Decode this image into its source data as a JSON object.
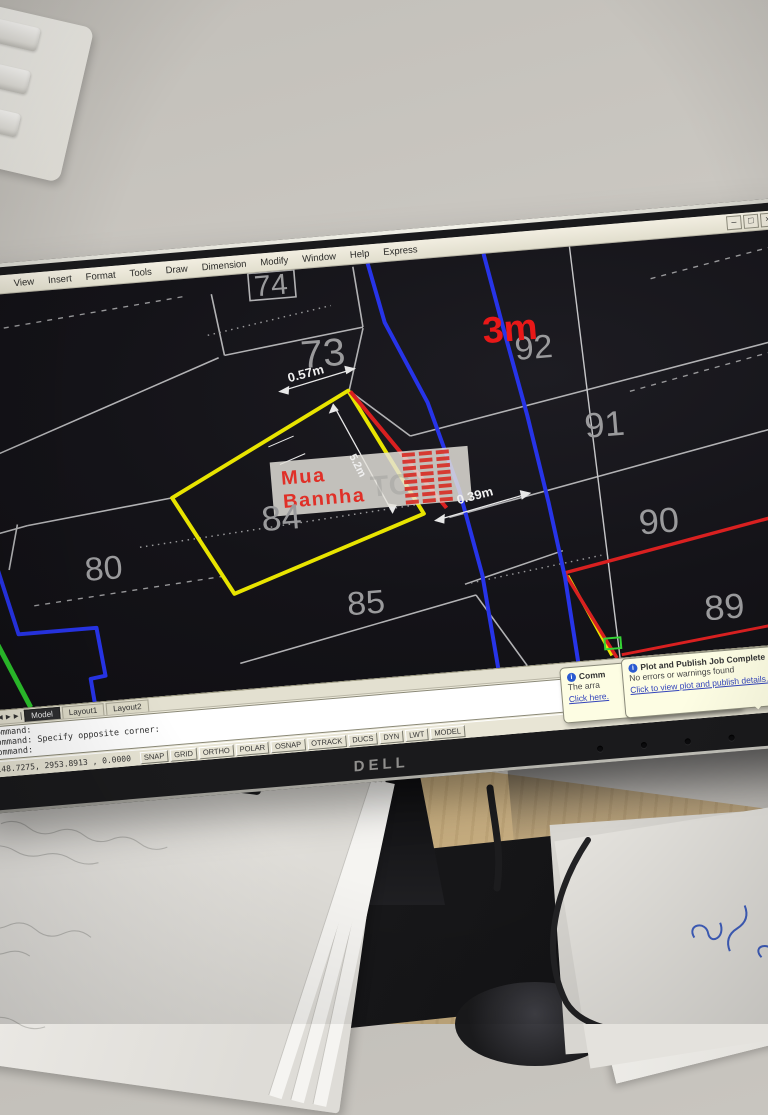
{
  "scene": {
    "wall_color": "#cbc8c2",
    "desk_color": "#c9b086",
    "monitor_brand": "DELL"
  },
  "app": {
    "menu": {
      "items": [
        "File",
        "Edit",
        "View",
        "Insert",
        "Format",
        "Tools",
        "Draw",
        "Dimension",
        "Modify",
        "Window",
        "Help",
        "Express"
      ]
    },
    "window_buttons": {
      "minimize": "–",
      "restore": "□",
      "close": "×"
    },
    "map": {
      "background": "#141318",
      "line_colors": {
        "parcel_gray": "#b2b2b4",
        "highlight_yellow": "#e8e400",
        "road_blue": "#2734e8",
        "boundary_red": "#d92020",
        "utility_green": "#2cc42c",
        "dimension_white": "#eeeeee"
      },
      "parcels": [
        {
          "label": "74",
          "x": 322,
          "y": 24,
          "size": 30
        },
        {
          "label": "73",
          "x": 368,
          "y": 102,
          "size": 40
        },
        {
          "label": "92",
          "x": 578,
          "y": 112,
          "size": 34
        },
        {
          "label": "91",
          "x": 642,
          "y": 198,
          "size": 36
        },
        {
          "label": "90",
          "x": 688,
          "y": 302,
          "size": 36
        },
        {
          "label": "89",
          "x": 746,
          "y": 396,
          "size": 36
        },
        {
          "label": "84",
          "x": 313,
          "y": 266,
          "size": 36
        },
        {
          "label": "85",
          "x": 390,
          "y": 360,
          "size": 34
        },
        {
          "label": "80",
          "x": 132,
          "y": 302,
          "size": 34
        },
        {
          "label": "3m",
          "x": 556,
          "y": 92,
          "size": 38,
          "color": "#e81818",
          "bold": true
        }
      ],
      "dimensions": [
        {
          "label": "0.57m",
          "x": 350,
          "y": 112,
          "rot": -10,
          "size": 13
        },
        {
          "label": "5.2m",
          "x": 390,
          "y": 208,
          "rot": 68,
          "size": 11
        },
        {
          "label": "0.39m",
          "x": 508,
          "y": 252,
          "rot": -10,
          "size": 13
        }
      ],
      "watermark": {
        "line1": "Mua",
        "line2": "Bannha",
        "color": "#e03028",
        "faint": "TC"
      }
    },
    "tabs": {
      "nav": "|◄◄►►|",
      "items": [
        "Model",
        "Layout1",
        "Layout2"
      ]
    },
    "command_lines": [
      "Command:",
      "Command: Specify opposite corner:",
      "Command:"
    ],
    "status": {
      "coords": "4148.7275, 2953.8913 , 0.0000",
      "toggles": [
        "SNAP",
        "GRID",
        "ORTHO",
        "POLAR",
        "OSNAP",
        "OTRACK",
        "DUCS",
        "DYN",
        "LWT",
        "MODEL"
      ]
    },
    "balloons": {
      "back": {
        "title": "Comm",
        "body": "The arra",
        "link": "Click here."
      },
      "front": {
        "title": "Plot and Publish Job Complete",
        "body": "No errors or warnings found",
        "link": "Click to view plot and publish details...",
        "close": "×"
      }
    }
  }
}
